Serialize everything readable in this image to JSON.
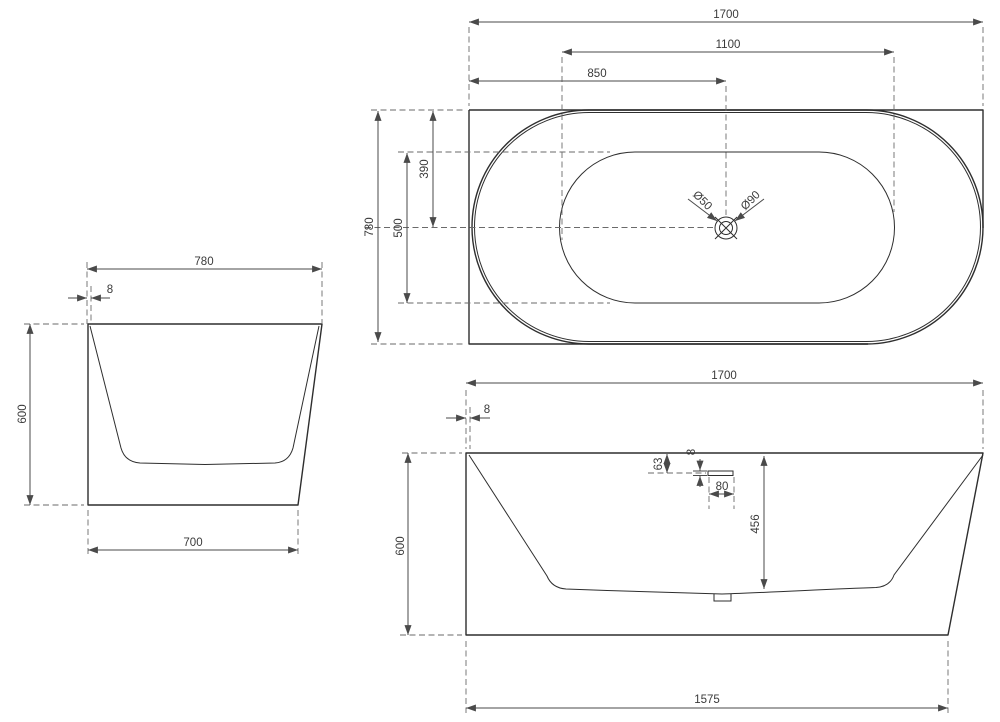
{
  "drawing": {
    "type": "bathtub technical drawing, three orthographic views",
    "background": "#ffffff",
    "colors": {
      "outline": "#2e2e2e",
      "dimension": "#4a4a4a",
      "dashed": "#6a6a6a",
      "text": "#3a3a3a"
    }
  },
  "plan_view": {
    "dims": {
      "overall_length": "1700",
      "inner_length": "1100",
      "drain_from_left": "850",
      "overall_width": "780",
      "inner_width": "500",
      "drain_from_back": "390"
    },
    "drain": {
      "small": "Ø50",
      "large": "Ø90"
    }
  },
  "side_view": {
    "dims": {
      "top_width": "780",
      "wall_thickness": "8",
      "height": "600",
      "base_width": "700"
    }
  },
  "front_view": {
    "dims": {
      "overall_length": "1700",
      "wall_thickness": "8",
      "height": "600",
      "inner_depth": "456",
      "overflow_from_top": "63",
      "overflow_height": "8",
      "overflow_width": "80",
      "base_length": "1575"
    }
  }
}
